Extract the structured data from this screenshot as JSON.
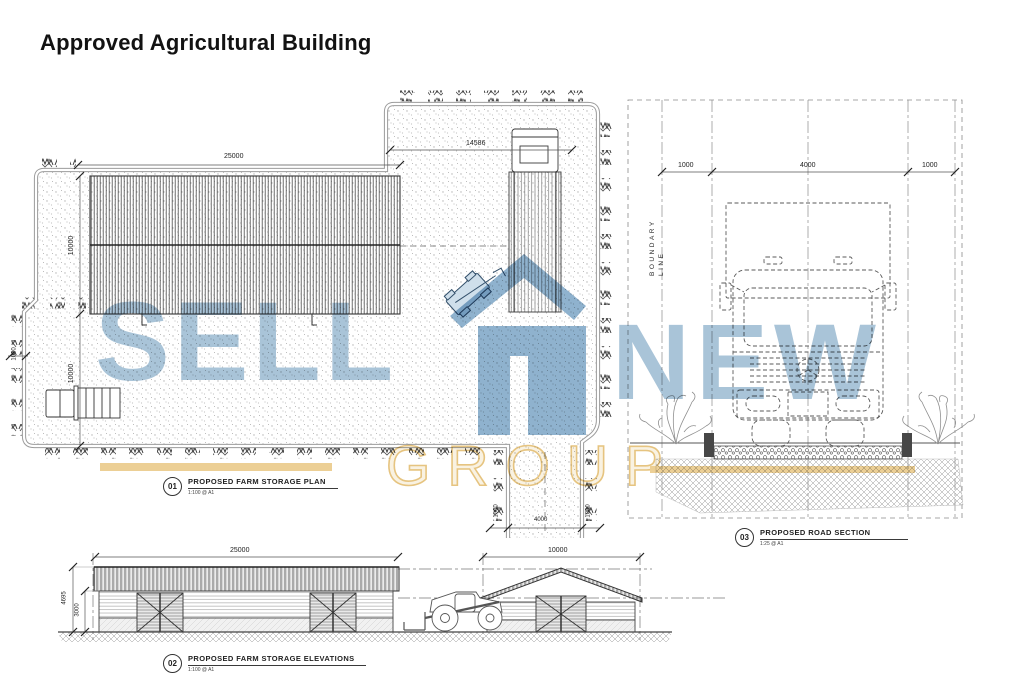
{
  "page": {
    "title": "Approved Agricultural Building"
  },
  "watermark": {
    "sell": "SELL",
    "new": "NEW",
    "group": "GROUP",
    "blue": "#a9c4d8",
    "logo_blue": "#8fb2ce",
    "yellow": "#eccf95"
  },
  "plan": {
    "ref": "01",
    "title": "PROPOSED FARM STORAGE PLAN",
    "scale": "1:100 @ A1",
    "dims": {
      "building_length": "25000",
      "yard_width": "14586",
      "building_depth": "10000",
      "yard_depth": "10000",
      "hedge_width": "1000",
      "verge_left": "1000",
      "drive_width": "4000",
      "verge_right": "1000"
    }
  },
  "elevations": {
    "ref": "02",
    "title": "PROPOSED FARM STORAGE ELEVATIONS",
    "scale": "1:100 @ A1",
    "dims": {
      "length": "25000",
      "gable_width": "10000",
      "ridge_height": "4695",
      "eaves_height": "3000"
    }
  },
  "road": {
    "ref": "03",
    "title": "PROPOSED ROAD SECTION",
    "scale": "1:25 @ A1",
    "boundary_word1": "BOUNDARY",
    "boundary_word2": "LINE",
    "dims": {
      "left_verge": "1000",
      "carriageway": "4000",
      "right_verge": "1000"
    }
  }
}
